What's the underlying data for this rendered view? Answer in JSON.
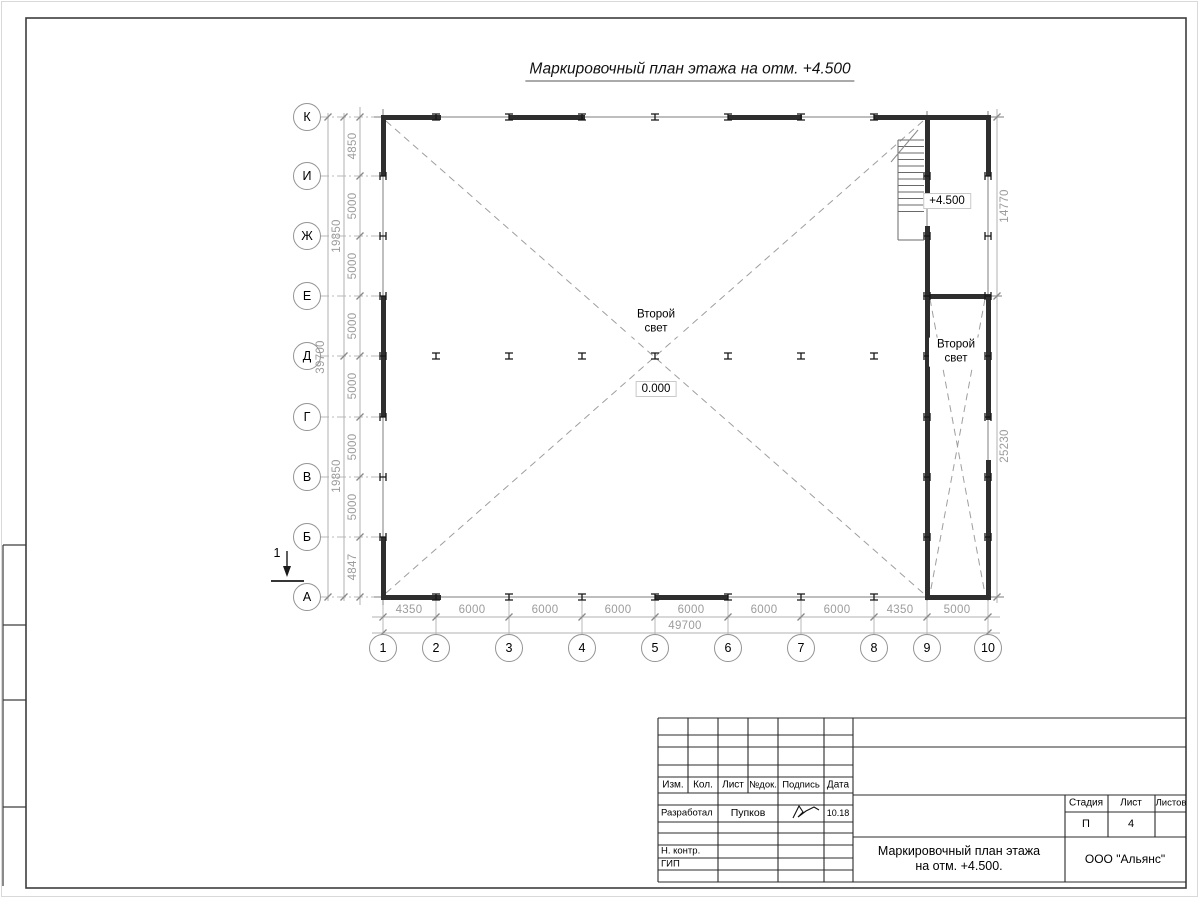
{
  "page_title": "Маркировочный план этажа на отм. +4.500",
  "plan": {
    "row_axes": [
      "К",
      "И",
      "Ж",
      "Е",
      "Д",
      "Г",
      "В",
      "Б",
      "А"
    ],
    "col_axes": [
      "1",
      "2",
      "3",
      "4",
      "5",
      "6",
      "7",
      "8",
      "9",
      "10"
    ],
    "dims": {
      "left_steps": [
        "4850",
        "5000",
        "5000",
        "5000",
        "5000",
        "5000",
        "5000",
        "4847"
      ],
      "left_mids": [
        "19850",
        "19850"
      ],
      "left_total": "39700",
      "bottom_steps": [
        "4350",
        "6000",
        "6000",
        "6000",
        "6000",
        "6000",
        "6000",
        "4350",
        "5000"
      ],
      "bottom_total": "49700",
      "right_upper": "14770",
      "right_lower": "25230"
    },
    "labels": {
      "second_light_hall": "Второй свет",
      "second_light_strip": "Второй свет",
      "level_zero": "0.000",
      "level_plus": "+4.500",
      "section_mark": "1"
    }
  },
  "titleblock": {
    "header_cols": [
      "Изм.",
      "Кол.",
      "Лист",
      "№док.",
      "Подпись",
      "Дата"
    ],
    "row_developed": {
      "role": "Разработал",
      "name": "Пупков",
      "date": "10.18"
    },
    "row_ncontrol": "Н. контр.",
    "row_gip": "ГИП",
    "stage_label": "Стадия",
    "sheet_label": "Лист",
    "sheets_label": "Листов",
    "stage_value": "П",
    "sheet_value": "4",
    "doc_title_line1": "Маркировочный план этажа",
    "doc_title_line2": "на отм. +4.500.",
    "company": "ООО \"Альянс\""
  }
}
